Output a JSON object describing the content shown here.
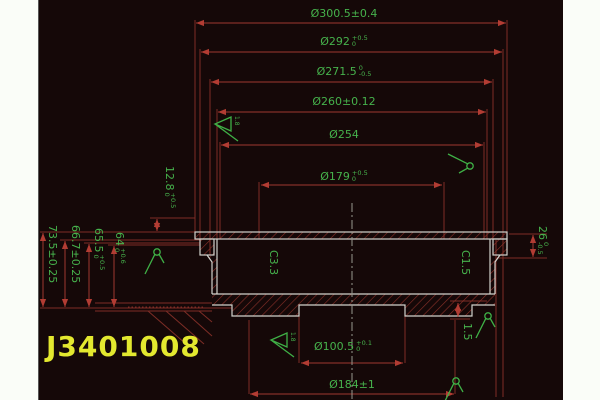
{
  "part_number": "J3401008",
  "colors": {
    "page_background": "#fafdf8",
    "drawing_background": "#150808",
    "dimension_red": "#a03830",
    "text_green": "#46b24c",
    "part_outline_gray": "#d2d2cc",
    "part_number_yellow": "#e3e82f"
  },
  "dims": {
    "d300": {
      "text": "Ø300.5±0.4"
    },
    "d292": {
      "value": "Ø292",
      "tol_up": "+0.5",
      "tol_dn": "0"
    },
    "d271": {
      "value": "Ø271.5",
      "tol_up": "0",
      "tol_dn": "-0.5"
    },
    "d260": {
      "text": "Ø260±0.12"
    },
    "d254": {
      "text": "Ø254"
    },
    "d179": {
      "value": "Ø179",
      "tol_up": "+0.5",
      "tol_dn": "0"
    },
    "d100": {
      "value": "Ø100.5",
      "tol_up": "+0.1",
      "tol_dn": "0"
    },
    "d184": {
      "text": "Ø184±1"
    },
    "h73": {
      "text": "73.5±0.25"
    },
    "h66": {
      "text": "66.7±0.25"
    },
    "h65": {
      "value": "65.5",
      "tol_up": "+0.5",
      "tol_dn": "0"
    },
    "h64": {
      "value": "64",
      "tol_up": "+0.6",
      "tol_dn": "0"
    },
    "h12": {
      "value": "12.8",
      "tol_up": "+0.5",
      "tol_dn": "0"
    },
    "h26": {
      "value": "26",
      "tol_up": "0",
      "tol_dn": "-0.5"
    },
    "h15": {
      "text": "1.5"
    }
  },
  "chamfers": {
    "left": "C3.3",
    "right": "C1.5"
  },
  "roughness": {
    "flag_top": "1.8",
    "flag_bottom": "1.8"
  }
}
